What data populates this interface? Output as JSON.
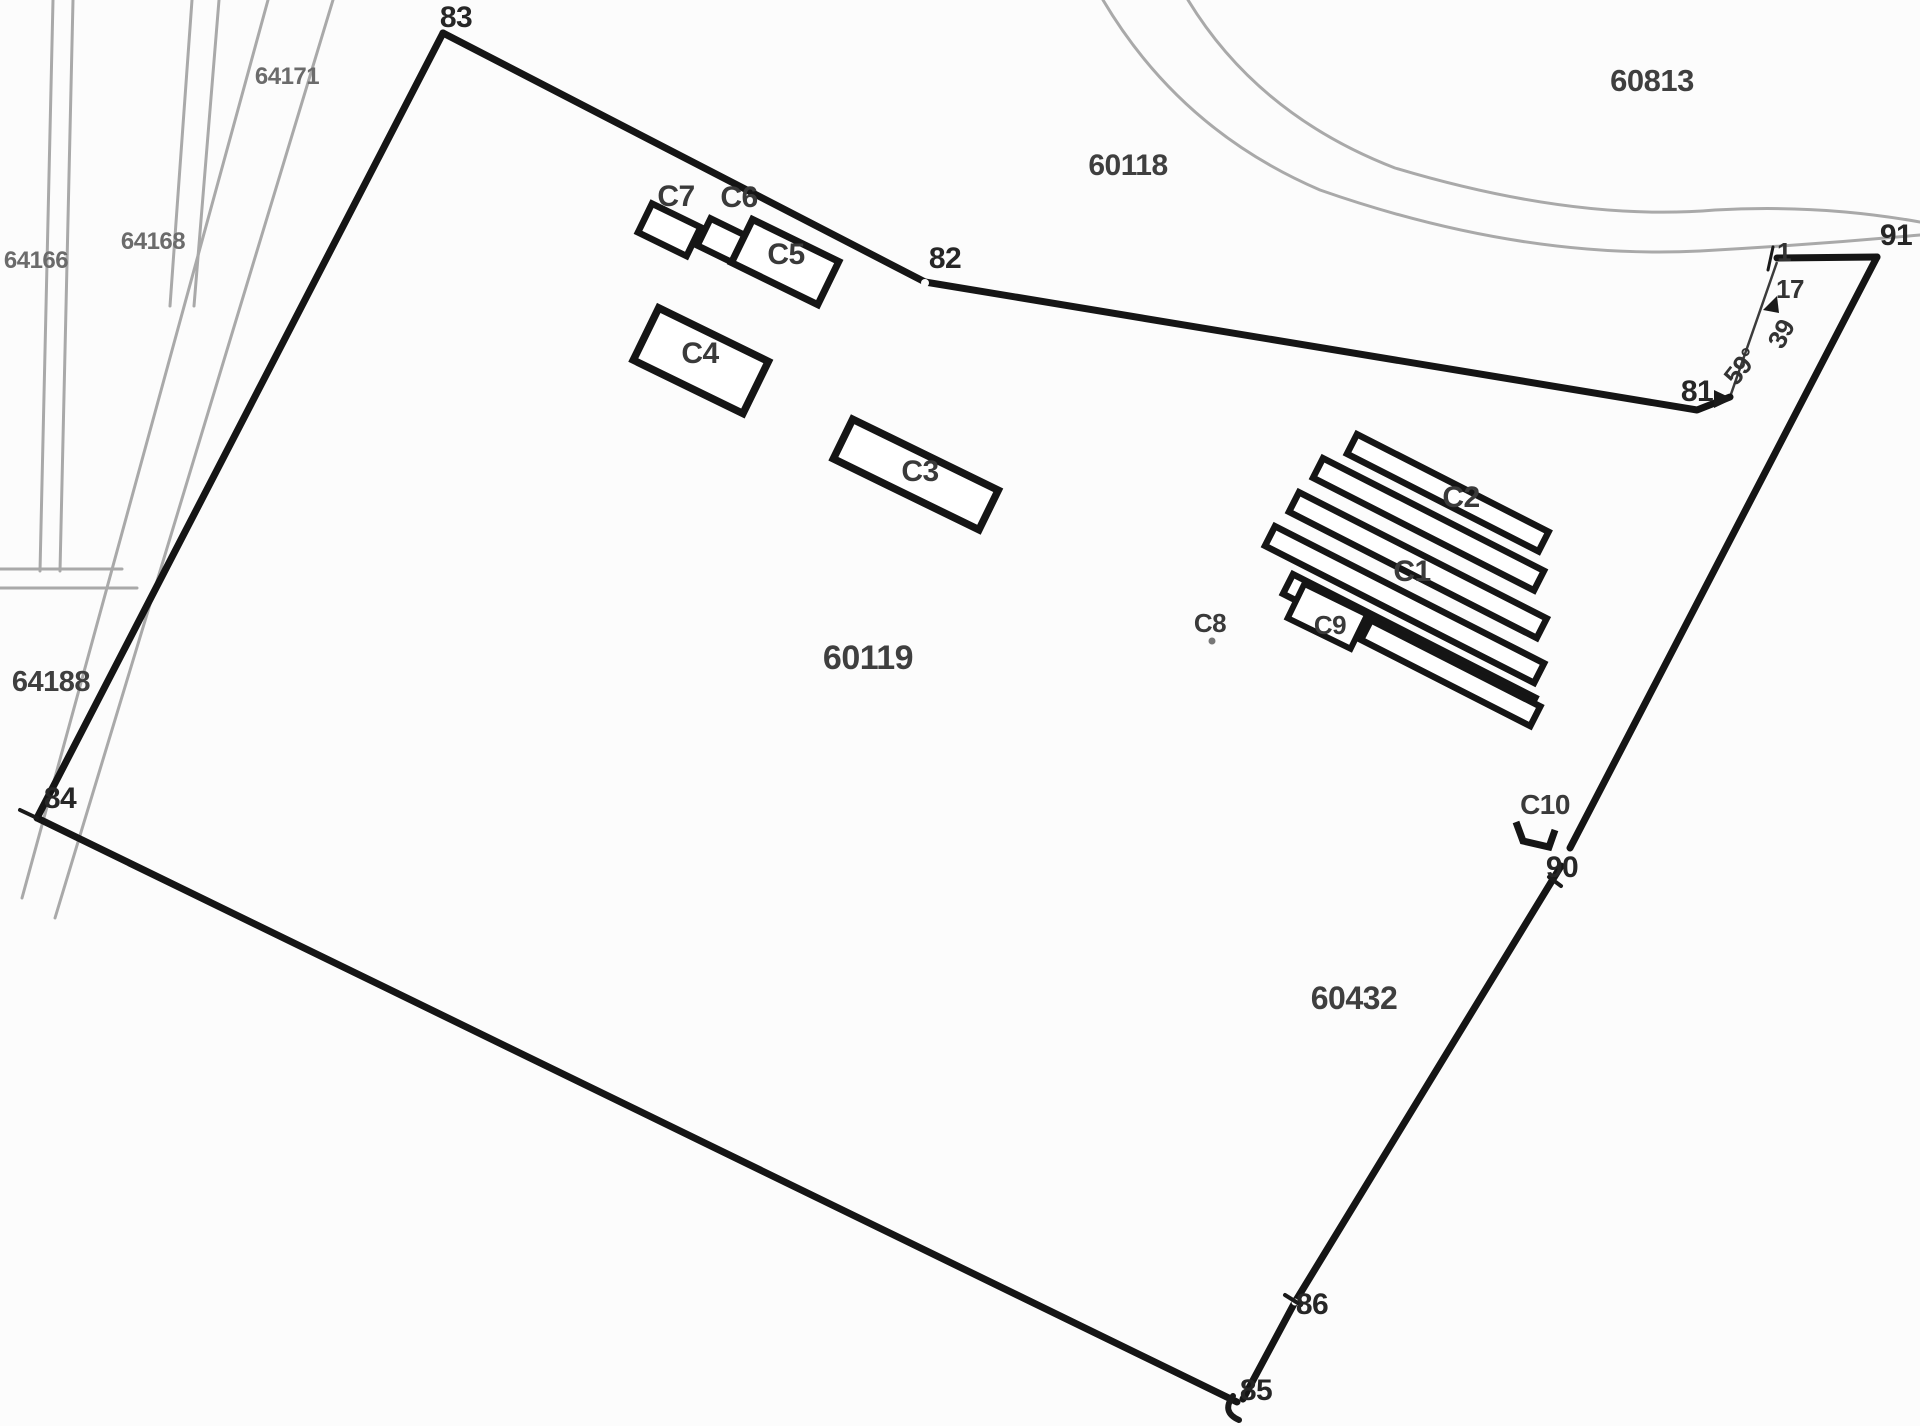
{
  "map": {
    "type": "cadastral-plan",
    "colors": {
      "background": "#fcfcfc",
      "boundary": "#151515",
      "building": "#151515",
      "cadastral_line": "#a9a9a9",
      "parcel_label": "#3f3f3f",
      "area_label_gray": "#6b6b6b",
      "point_label": "#262626",
      "building_label": "#3a3a3a",
      "measurement_label": "#333333"
    },
    "parcel_labels": {
      "p60119": "60119",
      "p60118": "60118",
      "p60813": "60813",
      "p60432": "60432",
      "p64188": "64188",
      "p64166": "64166",
      "p64168": "64168",
      "p64171": "64171"
    },
    "point_labels": {
      "p83": "83",
      "p82": "82",
      "p81": "81",
      "p84": "84",
      "p85": "85",
      "p86": "86",
      "p90": "90",
      "p91": "91"
    },
    "measurement_labels": {
      "m1": "1",
      "m17": "17",
      "m39": "39",
      "m59": "59°"
    },
    "building_labels": {
      "c1": "C1",
      "c2": "C2",
      "c3": "C3",
      "c4": "C4",
      "c5": "C5",
      "c6": "C6",
      "c7": "C7",
      "c8": "C8",
      "c9": "C9",
      "c10": "C10"
    }
  }
}
